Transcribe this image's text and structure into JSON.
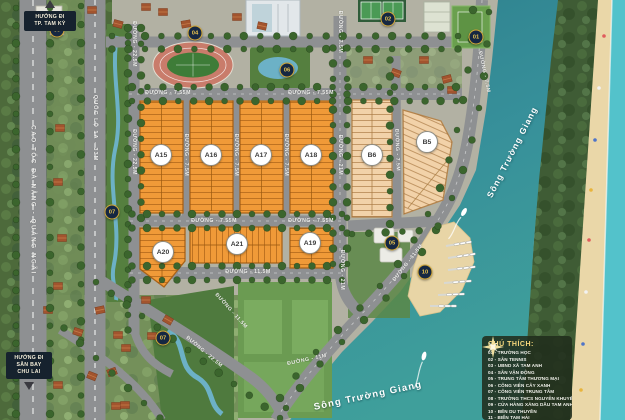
{
  "map": {
    "legend": {
      "title": "CHÚ THÍCH:",
      "items": [
        {
          "num": "01",
          "label": "TRƯỜNG HỌC"
        },
        {
          "num": "02",
          "label": "SÂN TENNIS"
        },
        {
          "num": "03",
          "label": "UBND XÃ TAM ANH"
        },
        {
          "num": "04",
          "label": "SÂN VẬN ĐỘNG"
        },
        {
          "num": "05",
          "label": "TRUNG TÂM THƯƠNG MẠI"
        },
        {
          "num": "06",
          "label": "CÔNG VIÊN CÂY XANH"
        },
        {
          "num": "07",
          "label": "CÔNG VIÊN TRUNG TÂM"
        },
        {
          "num": "08",
          "label": "TRƯỜNG THCS NGUYỄN KHUYẾN"
        },
        {
          "num": "09",
          "label": "CỬA HÀNG XĂNG DẦU TAM ANH NAM 2"
        },
        {
          "num": "10",
          "label": "BẾN DU THUYỀN"
        },
        {
          "num": "11",
          "label": "BIỂN TAM HẢI"
        }
      ]
    },
    "directions": [
      {
        "id": "tam-ky",
        "lines": [
          "HƯỚNG ĐI",
          "TP. TAM KỲ"
        ]
      },
      {
        "id": "chu-lai",
        "lines": [
          "HƯỚNG ĐI",
          "SÂN BAY",
          "CHU LAI"
        ]
      }
    ],
    "river_labels": [
      {
        "text": "Sông Trường Giang",
        "x": 512,
        "y": 152,
        "rot": -63,
        "size": 8.5
      },
      {
        "text": "Sông Trường Giang",
        "x": 368,
        "y": 396,
        "rot": -12,
        "size": 9.5
      }
    ],
    "road_labels": [
      {
        "text": "CAO TỐC ĐÀ NẴNG - QUẢNG NGÃI",
        "x": 33,
        "y": 200,
        "rot": 90,
        "size": 6.2,
        "ls": 1.6
      },
      {
        "text": "QUỐC LỘ 1A - 33M",
        "x": 95,
        "y": 128,
        "rot": 90,
        "size": 5.6,
        "ls": 1
      },
      {
        "text": "ĐƯỜNG - 22.5M",
        "x": 134,
        "y": 44,
        "rot": 90
      },
      {
        "text": "ĐƯỜNG - 22.5M",
        "x": 134,
        "y": 152,
        "rot": 90
      },
      {
        "text": "ĐƯỜNG - 7.55M",
        "x": 168,
        "y": 93,
        "rot": 0
      },
      {
        "text": "ĐƯỜNG - 7.55M",
        "x": 311,
        "y": 93,
        "rot": 0
      },
      {
        "text": "ĐƯỜNG - 7.55M",
        "x": 214,
        "y": 221,
        "rot": 0
      },
      {
        "text": "ĐƯỜNG - 7.55M",
        "x": 311,
        "y": 221,
        "rot": 0
      },
      {
        "text": "ĐƯỜNG - 11.5M",
        "x": 248,
        "y": 272,
        "rot": 0
      },
      {
        "text": "ĐƯỜNG - 7.5M",
        "x": 186,
        "y": 155,
        "rot": 90
      },
      {
        "text": "ĐƯỜNG - 7.5M",
        "x": 236,
        "y": 155,
        "rot": 90
      },
      {
        "text": "ĐƯỜNG - 7.5M",
        "x": 286,
        "y": 155,
        "rot": 90
      },
      {
        "text": "ĐƯỜNG - 7.5M",
        "x": 340,
        "y": 32,
        "rot": 90
      },
      {
        "text": "ĐƯỜNG - 21M",
        "x": 340,
        "y": 155,
        "rot": 90
      },
      {
        "text": "ĐƯỜNG - 21M",
        "x": 342,
        "y": 270,
        "rot": 90
      },
      {
        "text": "ĐƯỜNG - 7.5M",
        "x": 397,
        "y": 150,
        "rot": 88
      },
      {
        "text": "ĐƯỜNG - 7.5M",
        "x": 484,
        "y": 72,
        "rot": 78
      },
      {
        "text": "ĐƯỜNG - 11.5M",
        "x": 408,
        "y": 263,
        "rot": -52
      },
      {
        "text": "ĐƯỜNG - 11.5M",
        "x": 231,
        "y": 311,
        "rot": 48
      },
      {
        "text": "ĐƯỜNG - 22.5M",
        "x": 204,
        "y": 352,
        "rot": 40
      },
      {
        "text": "ĐƯỜNG - 11M",
        "x": 307,
        "y": 360,
        "rot": -12
      }
    ],
    "markers": [
      {
        "num": "09",
        "x": 57,
        "y": 30
      },
      {
        "num": "04",
        "x": 195,
        "y": 33
      },
      {
        "num": "02",
        "x": 388,
        "y": 19
      },
      {
        "num": "01",
        "x": 476,
        "y": 37
      },
      {
        "num": "06",
        "x": 287,
        "y": 70
      },
      {
        "num": "07",
        "x": 112,
        "y": 212
      },
      {
        "num": "05",
        "x": 392,
        "y": 243
      },
      {
        "num": "10",
        "x": 425,
        "y": 272
      },
      {
        "num": "07",
        "x": 163,
        "y": 338
      }
    ],
    "blocks": [
      {
        "id": "A15",
        "label": "A15",
        "points": "140,101 183,101 183,213 140,213",
        "fill": "#f09a38",
        "stroke": "#aa6318",
        "pattern": "lotO",
        "divColor": "#9c5a10",
        "cx": 161,
        "cy": 155,
        "div": [
          161.5,
          103,
          161.5,
          211
        ]
      },
      {
        "id": "A16",
        "label": "A16",
        "points": "190,101 233,101 233,213 190,213",
        "fill": "#f09a38",
        "stroke": "#aa6318",
        "pattern": "lotO",
        "divColor": "#9c5a10",
        "cx": 211,
        "cy": 155,
        "div": [
          211.5,
          103,
          211.5,
          211
        ]
      },
      {
        "id": "A17",
        "label": "A17",
        "points": "240,101 283,101 283,213 240,213",
        "fill": "#f09a38",
        "stroke": "#aa6318",
        "pattern": "lotO",
        "divColor": "#9c5a10",
        "cx": 261,
        "cy": 155,
        "div": [
          261.5,
          103,
          261.5,
          211
        ]
      },
      {
        "id": "A18",
        "label": "A18",
        "points": "290,101 333,101 333,213 290,213",
        "fill": "#f09a38",
        "stroke": "#aa6318",
        "pattern": "lotO",
        "divColor": "#9c5a10",
        "cx": 311,
        "cy": 155,
        "div": [
          311.5,
          103,
          311.5,
          211
        ]
      },
      {
        "id": "A20",
        "label": "A20",
        "points": "140,228 185,228 185,261 164,287 140,269",
        "fill": "#f09a38",
        "stroke": "#aa6318",
        "pattern": "lotO",
        "divColor": "#9c5a10",
        "cx": 163,
        "cy": 252,
        "div": [
          162,
          230,
          162,
          283
        ]
      },
      {
        "id": "A21",
        "label": "A21",
        "points": "190,227 282,227 282,263 190,263",
        "fill": "#f09a38",
        "stroke": "#aa6318",
        "pattern": "lotOV",
        "divColor": "#9c5a10",
        "cx": 237,
        "cy": 244,
        "div": [
          192,
          245,
          280,
          245
        ]
      },
      {
        "id": "A19",
        "label": "A19",
        "points": "290,228 333,228 333,268 290,268",
        "fill": "#f09a38",
        "stroke": "#aa6318",
        "pattern": "lotO",
        "divColor": "#9c5a10",
        "cx": 310,
        "cy": 243,
        "div": [
          311.5,
          230,
          311.5,
          266
        ]
      },
      {
        "id": "B6",
        "label": "B6",
        "points": "352,100 392,100 392,217 352,217",
        "fill": "#f2d2a9",
        "stroke": "#b5854d",
        "pattern": "lotB",
        "divColor": "#a97c42",
        "cx": 372,
        "cy": 155,
        "div": [
          372,
          102,
          372,
          215
        ]
      },
      {
        "id": "B5",
        "label": "B5",
        "points": "403,110 441,121 452,142 443,200 404,214",
        "fill": "#f2d2a9",
        "stroke": "#b5854d",
        "pattern": "lotB2",
        "divColor": "#a97c42",
        "cx": 427,
        "cy": 142,
        "div": [
          408,
          208,
          446,
          162
        ]
      }
    ]
  }
}
